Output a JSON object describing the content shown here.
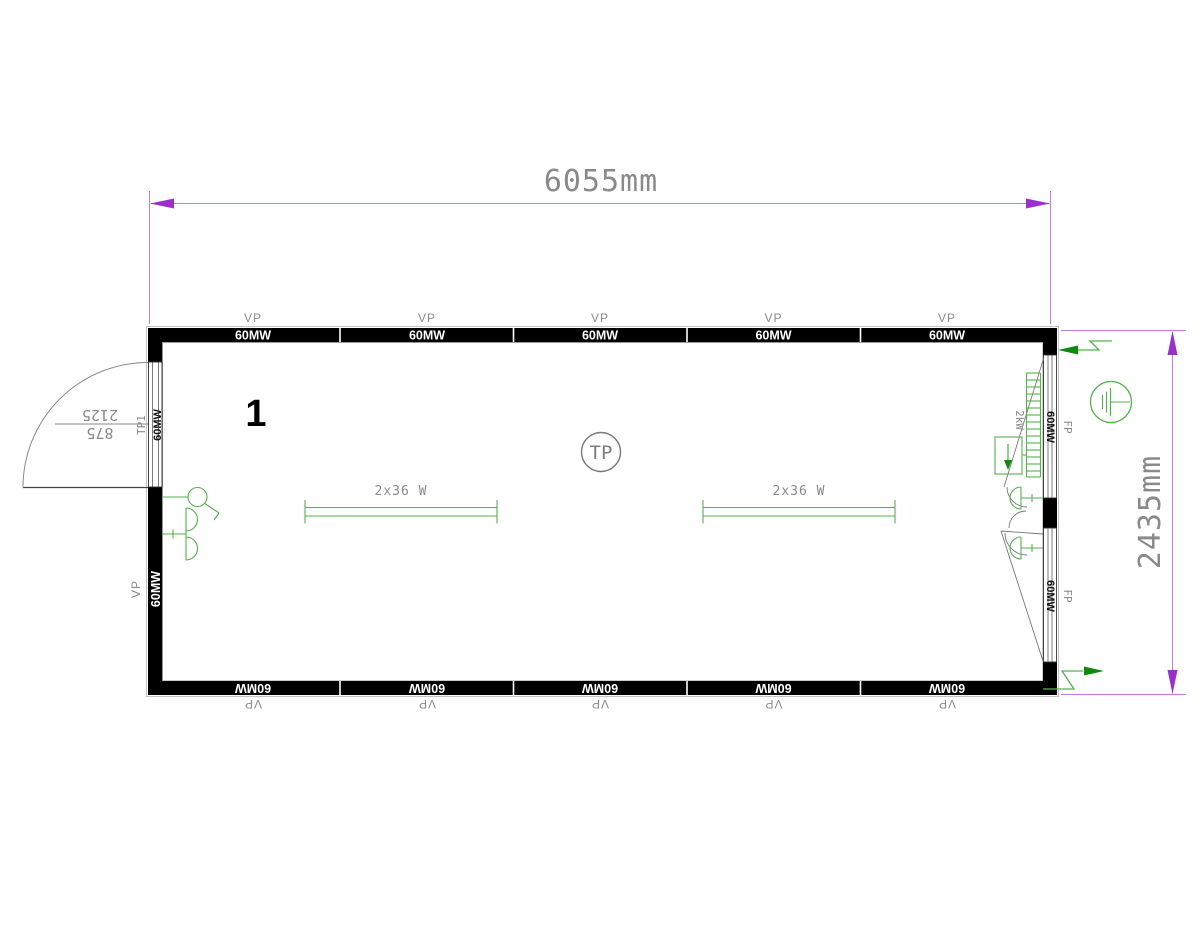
{
  "drawing": {
    "labels": {
      "width_dim": "6055mm",
      "height_dim": "2435mm",
      "room_number": "1",
      "tp": "TP",
      "tp1": "TP1",
      "vp": "VP",
      "panel": "60MW",
      "fp": "FP",
      "light": "2x36 W",
      "heater_power": "2kW",
      "door_width": "875",
      "door_height": "2125"
    },
    "colors": {
      "dimension_line": "#bb7de0",
      "dimension_arrow": "#9b2fc9",
      "annotation_gray": "#8a8a8a",
      "wall_black": "#000000",
      "electric_green": "#55b14e",
      "arrow_green": "#0f8a0f"
    }
  }
}
